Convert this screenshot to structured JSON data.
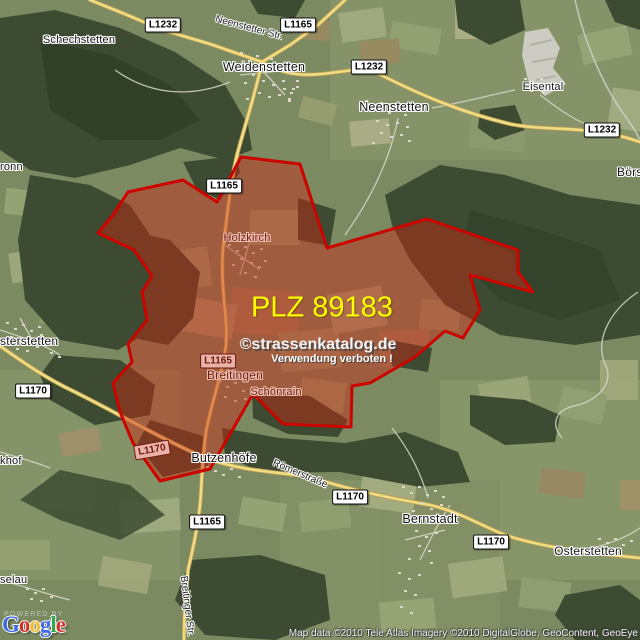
{
  "map": {
    "plz_label": "PLZ 89183",
    "watermark": {
      "line1": "©strassenkatalog.de",
      "line2": "Verwendung verboten !"
    },
    "attribution": "Map data ©2010 Tele Atlas  Imagery ©2010 DigitalGlobe, GeoContent, GeoEye",
    "powered_by": "POWERED BY",
    "logo_letters": [
      {
        "char": "G",
        "color": "#4169e1"
      },
      {
        "char": "o",
        "color": "#d6302c"
      },
      {
        "char": "o",
        "color": "#eebc2c"
      },
      {
        "char": "g",
        "color": "#4169e1"
      },
      {
        "char": "l",
        "color": "#30a850"
      },
      {
        "char": "e",
        "color": "#d6302c"
      }
    ],
    "colors": {
      "region_border": "#cc0400",
      "region_fill": "#c8281e",
      "road_yellow": "#f0dc82",
      "sign_pink_bg": "#e9b2a8",
      "plz_text": "#fdfd00",
      "forest_green": "#3c4b31",
      "field_green": "#7c8a62"
    }
  },
  "towns": [
    {
      "name": "Schechstetten"
    },
    {
      "name": "Weidenstetten"
    },
    {
      "name": "Neenstetten"
    },
    {
      "name": "Eisental"
    },
    {
      "name": "Börs"
    },
    {
      "name": "ronn"
    },
    {
      "name": "Holzkirch"
    },
    {
      "name": "sterstetten"
    },
    {
      "name": "Breitingen"
    },
    {
      "name": "Schönrain"
    },
    {
      "name": "Butzenhöfe"
    },
    {
      "name": "khof"
    },
    {
      "name": "Bernstadt"
    },
    {
      "name": "Osterstetten"
    },
    {
      "name": "selau"
    }
  ],
  "road_signs": [
    {
      "label": "L1232"
    },
    {
      "label": "L1165"
    },
    {
      "label": "L1232"
    },
    {
      "label": "L1232"
    },
    {
      "label": "L1165"
    },
    {
      "label": "L1165"
    },
    {
      "label": "L1170"
    },
    {
      "label": "L1170"
    },
    {
      "label": "L1170"
    },
    {
      "label": "L1165"
    },
    {
      "label": "L1170"
    }
  ],
  "streets": [
    {
      "name": "Neenstetter Str."
    },
    {
      "name": "Römerstraße"
    },
    {
      "name": "Breitinger Str."
    }
  ]
}
